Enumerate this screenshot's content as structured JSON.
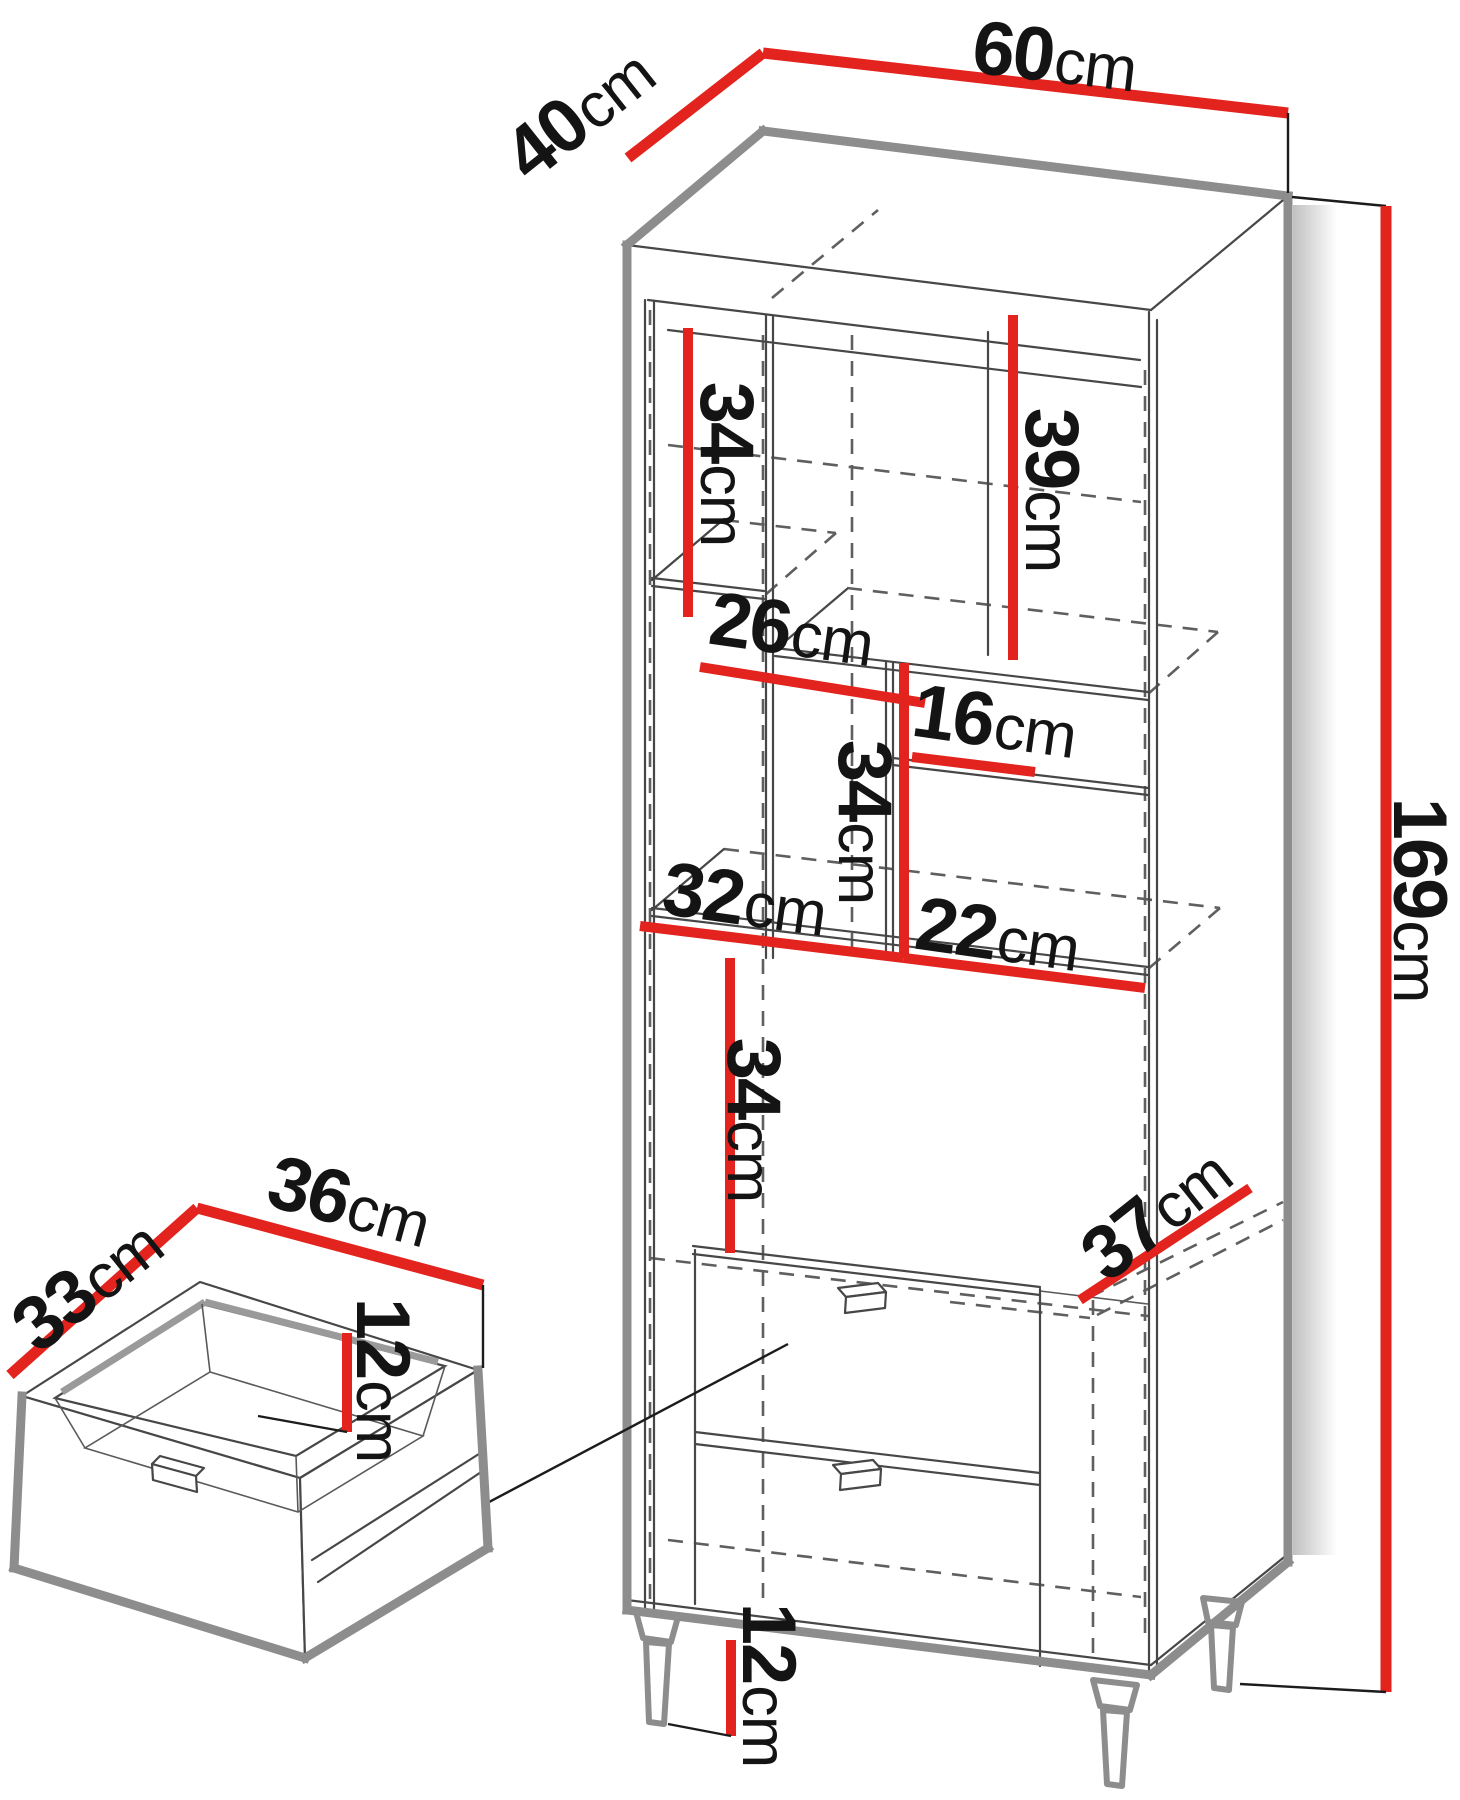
{
  "figure": {
    "kind": "furniture-dimension-diagram",
    "views": [
      "tall-cabinet-isometric",
      "drawer-detail-isometric"
    ],
    "units": "cm"
  },
  "colors": {
    "dimension_red": "#e2231e",
    "outline_gray": "#8d8d8d",
    "line_dark": "#474747",
    "dashed_gray": "#5f5f5f",
    "label_black": "#141414",
    "background": "#ffffff"
  },
  "cabinet": {
    "overall": {
      "width": {
        "value": "60",
        "unit": "cm"
      },
      "depth": {
        "value": "40",
        "unit": "cm"
      },
      "height": {
        "value": "169",
        "unit": "cm"
      }
    },
    "interior": {
      "upper_left_height": {
        "value": "34",
        "unit": "cm"
      },
      "upper_right_height": {
        "value": "39",
        "unit": "cm"
      },
      "shelf_width_left": {
        "value": "26",
        "unit": "cm"
      },
      "niche_width_small": {
        "value": "16",
        "unit": "cm"
      },
      "middle_height": {
        "value": "34",
        "unit": "cm"
      },
      "lower_left_width": {
        "value": "32",
        "unit": "cm"
      },
      "lower_right_width": {
        "value": "22",
        "unit": "cm"
      },
      "lower_height": {
        "value": "34",
        "unit": "cm"
      },
      "inner_depth": {
        "value": "37",
        "unit": "cm"
      }
    },
    "legs": {
      "height": {
        "value": "12",
        "unit": "cm"
      }
    }
  },
  "drawer_detail": {
    "inner_depth": {
      "value": "33",
      "unit": "cm"
    },
    "inner_width": {
      "value": "36",
      "unit": "cm"
    },
    "inner_height": {
      "value": "12",
      "unit": "cm"
    }
  }
}
